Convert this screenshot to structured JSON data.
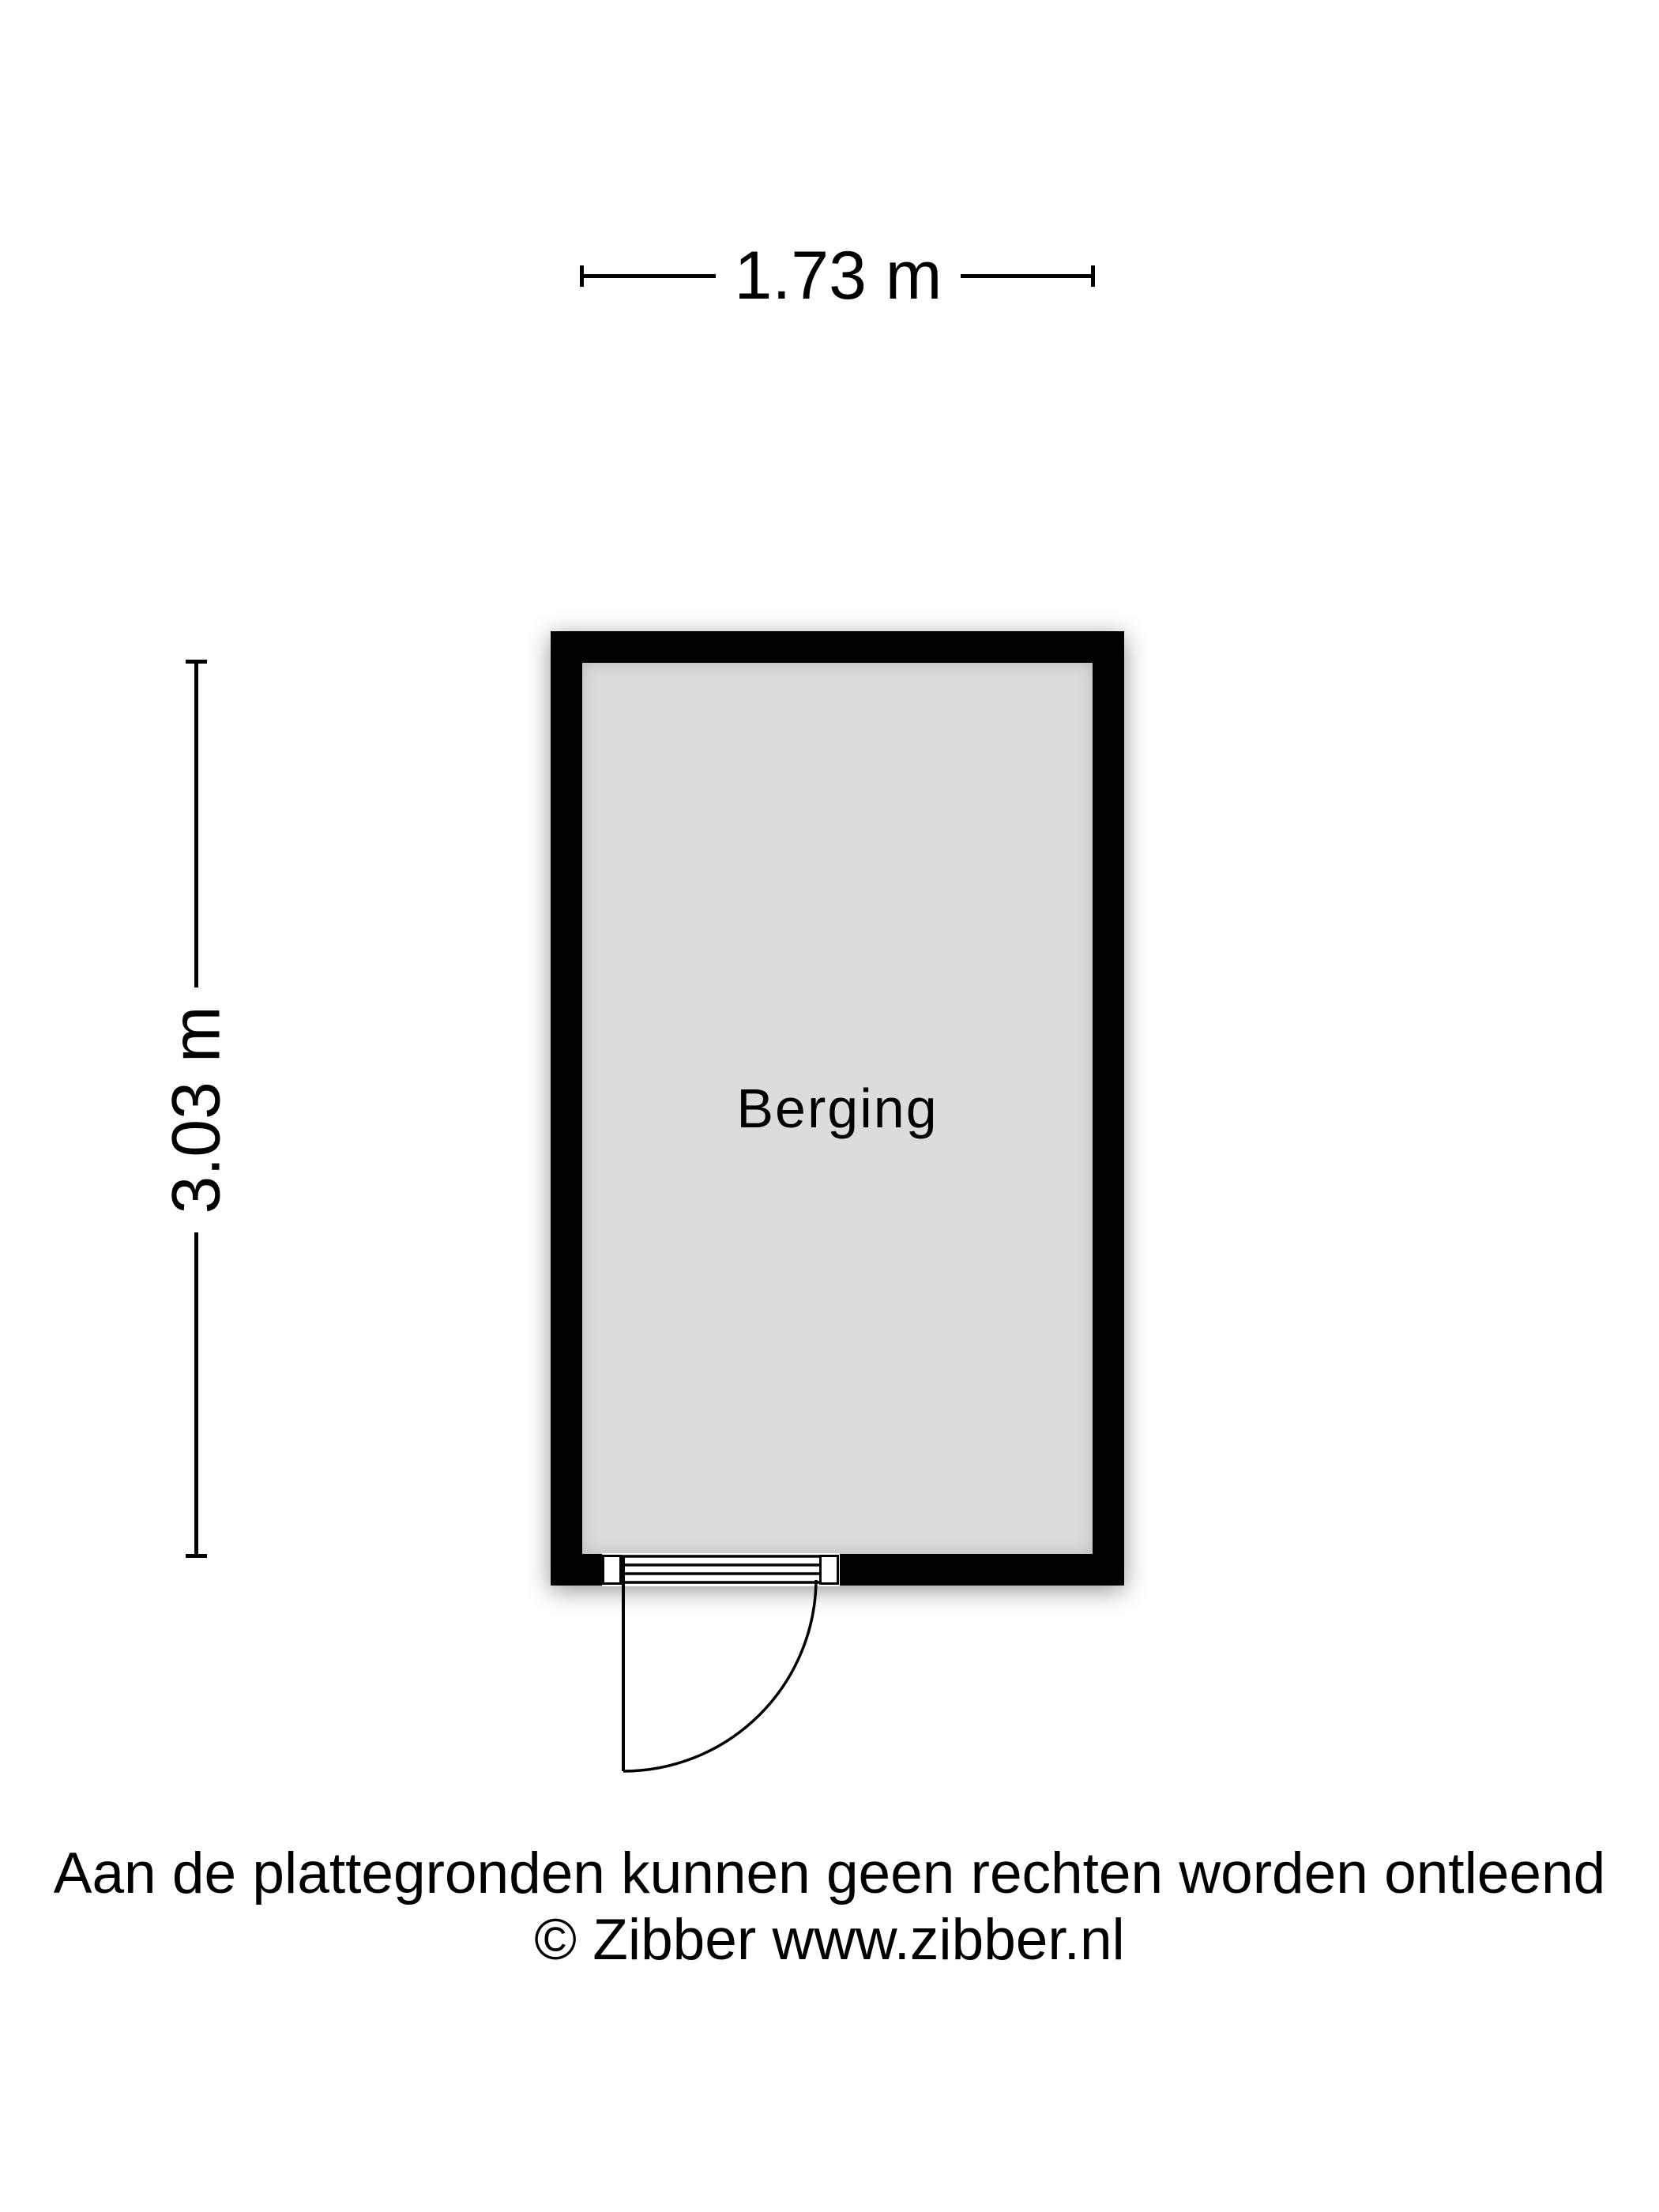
{
  "dimensions": {
    "width": {
      "label": "1.73 m"
    },
    "height": {
      "label": "3.03 m"
    }
  },
  "room": {
    "label": "Berging"
  },
  "footer": {
    "disclaimer": "Aan de plattegronden kunnen geen rechten worden ontleend",
    "copyright": "© Zibber www.zibber.nl"
  },
  "colors": {
    "wall": "#000000",
    "floor": "#dcdcdc",
    "background": "#ffffff",
    "ink": "#000000"
  }
}
